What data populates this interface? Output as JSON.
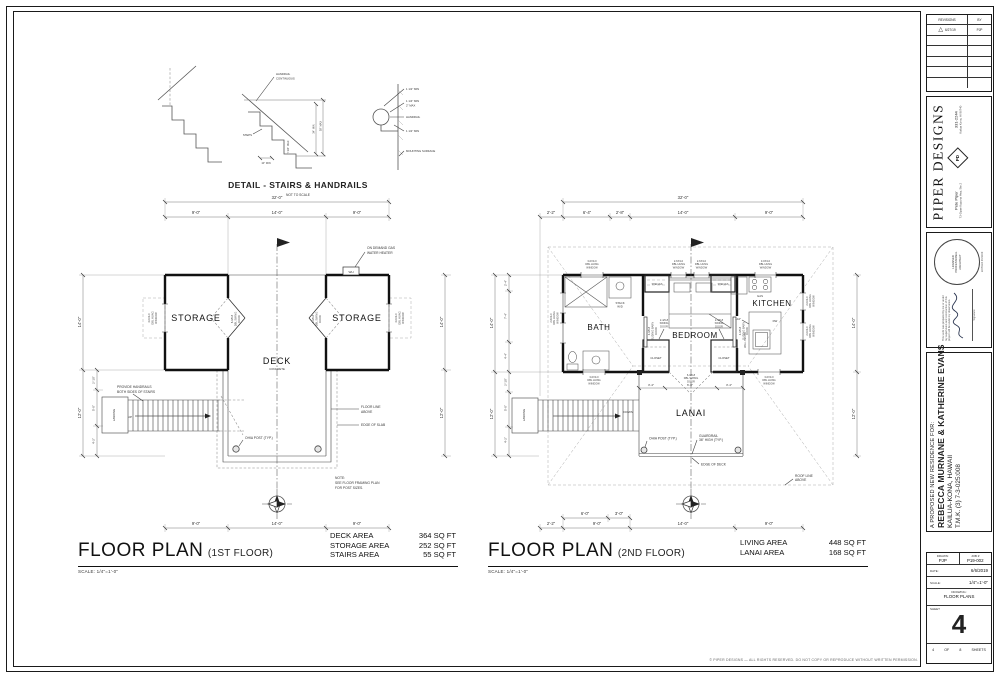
{
  "sheet": {
    "copyright": "© PIPER DESIGNS — ALL RIGHTS RESERVED. DO NOT COPY OR REPRODUCE WITHOUT WRITTEN PERMISSION."
  },
  "detail": {
    "title": "DETAIL - STAIRS & HANDRAILS",
    "scale_note": "NOT TO SCALE",
    "handrail_1": "HANDRAIL",
    "handrail_2": "CONTINUOUS",
    "steps": "STEPS",
    "tread": "10\" MIN",
    "riser": "7 3/4\" MAX",
    "rail_min": "34\" MIN",
    "rail_max": "38\" MAX",
    "clear_top": "1 1/2\" MIN",
    "grip_1": "1 1/4\" MIN",
    "grip_2": "2\" MAX",
    "handrail": "HANDRAIL",
    "clear_side": "1 1/2\" MIN",
    "mounting": "MOUNTING SURFACE"
  },
  "floor1": {
    "title": "FLOOR PLAN",
    "subtitle": "(1ST FLOOR)",
    "scale": "SCALE: 1/4\"=1'-0\"",
    "areas": [
      {
        "label": "DECK AREA",
        "value": "364 SQ FT"
      },
      {
        "label": "STORAGE AREA",
        "value": "252 SQ FT"
      },
      {
        "label": "STAIRS AREA",
        "value": "55 SQ FT"
      }
    ],
    "rooms": {
      "storage": "STORAGE",
      "deck": "DECK",
      "deck_sub": "CONCRETE",
      "landing": "LANDING",
      "up": "UP"
    },
    "dims": {
      "overall": "32'-0\"",
      "top": [
        "9'-0\"",
        "14'-0\"",
        "9'-0\""
      ],
      "bottom": [
        "9'-0\"",
        "14'-0\"",
        "9'-0\""
      ],
      "left": [
        "14'-0\"",
        "12'-0\""
      ],
      "right": [
        "14'-0\"",
        "12'-0\""
      ],
      "left_sub": [
        "2'-10\"",
        "5'-0\"",
        "4'-2\""
      ]
    },
    "callouts": {
      "wh": "WH",
      "water_heater_1": "ON DEMAND GAS",
      "water_heater_2": "WATER HEATER",
      "handrails_1": "PROVIDE HANDRAILS",
      "handrails_2": "BOTH SIDES OF STAIRS",
      "floor_line_1": "FLOOR LINE",
      "floor_line_2": "ABOVE",
      "edge_slab": "EDGE OF SLAB",
      "post": "OHIA POST (TYP.)",
      "note_1": "NOTE:",
      "note_2": "SEE FLOOR FRAMING PLAN",
      "note_3": "FOR POST SIZES."
    },
    "tags": {
      "window": [
        "4-0X3-0",
        "DBL HUNG",
        "WINDOW"
      ],
      "door": [
        "6-0/6-8",
        "DBL SWING",
        "DOOR"
      ]
    }
  },
  "floor2": {
    "title": "FLOOR PLAN",
    "subtitle": "(2ND FLOOR)",
    "scale": "SCALE: 1/4\"=1'-0\"",
    "areas": [
      {
        "label": "LIVING AREA",
        "value": "448 SQ FT"
      },
      {
        "label": "LANAI AREA",
        "value": "168 SQ FT"
      }
    ],
    "rooms": {
      "bath": "BATH",
      "bedroom": "BEDROOM",
      "kitchen": "KITCHEN",
      "lanai": "LANAI",
      "closet": "CLOSET",
      "shelves": "SHELVES",
      "stack": "STACK",
      "wd": "W/D",
      "landing": "LANDING",
      "down": "DOWN",
      "gas": "GAS",
      "dw": "DW",
      "counter": "+42\"",
      "wall_below": "WALL BELOW"
    },
    "dims": {
      "overall": "32'-0\"",
      "top": [
        "2'-2\"",
        "6'-4\"",
        "2'-8\"",
        "14'-0\"",
        "9'-0\""
      ],
      "bottom": [
        "2'-2\"",
        "9'-0\"",
        "14'-0\"",
        "9'-0\""
      ],
      "bottom_sub": [
        "6'-0\"",
        "3'-0\""
      ],
      "left": [
        "14'-0\"",
        "12'-0\""
      ],
      "right": [
        "14'-0\"",
        "12'-0\""
      ],
      "left_sub_upper": [
        "2'-4\"",
        "7'-4\"",
        "4'-4\""
      ],
      "left_sub_lower": [
        "2'-10\"",
        "5'-0\"",
        "4'-2\""
      ],
      "lanai": [
        "3'-4\"",
        "6'-8\"",
        "3'-4\""
      ]
    },
    "callouts": {
      "post": "OHIA POST (TYP.)",
      "guardrail_1": "GUARDRAIL",
      "guardrail_2": "36\" HIGH (TYP.)",
      "edge_deck": "EDGE OF DECK",
      "roof_1": "ROOF LINE",
      "roof_2": "ABOVE"
    },
    "tags": {
      "w3030": [
        "3-0X3-0",
        "DBL HUNG",
        "WINDOW"
      ],
      "w2630": [
        "2-6X3-0",
        "DBL HUNG",
        "WINDOW"
      ],
      "w2030": [
        "2-0X3-0",
        "DBL HUNG",
        "WINDOW"
      ],
      "barn": [
        "4-0/6-8",
        "SLIDING BARN",
        "DOOR"
      ],
      "swing": [
        "2-4/6-8",
        "SWING",
        "DOOR"
      ],
      "dbl": [
        "6-0/6-8",
        "DBL SWING",
        "DOOR"
      ]
    }
  },
  "titleblock": {
    "revisions": {
      "header": "REVISIONS",
      "by": "BY",
      "rev_date": "6/27/19",
      "rev_by": "PJP",
      "delta": "△"
    },
    "firm": {
      "name": "PIPER DESIGNS",
      "contact": "Pete Piper",
      "phone": "331-2244",
      "address1": "73-Opae Kupuna Hwy, Ste 2",
      "address2": "Kailua Kona, HI 96740",
      "logo": "PD"
    },
    "stamp": {
      "line1": "LICENSED",
      "line2": "PROFESSIONAL",
      "line3": "ARCHITECT",
      "expiry": "EXPIRES 04/30/20",
      "signature_label": "Signature",
      "disclaimer_1": "This work was prepared by me or under",
      "disclaimer_2": "my supervision and construction of this",
      "disclaimer_3": "project will be under my observation."
    },
    "project": {
      "line1": "A PROPOSED NEW RESIDENCE FOR:",
      "line2": "REBECCA MURNANE & KATHERINE EVANS",
      "line3": "KAILUA-KONA, HAWAII",
      "line4": "T.M.K. (3) 7-3-025:008"
    },
    "info": {
      "drawn_label": "DRAWN:",
      "drawn": "PJP",
      "job_label": "JOB #",
      "job": "P19-002",
      "date_label": "DATE:",
      "date": "6/6/2019",
      "scale_label": "SCALE:",
      "scale": "1/4\"=1'-0\"",
      "drawing_label": "DRAWING:",
      "drawing": "FLOOR PLANS",
      "sheet_label": "SHEET",
      "sheet": "4",
      "of_label": "OF",
      "total": "8",
      "sheets_label": "SHEETS"
    }
  }
}
